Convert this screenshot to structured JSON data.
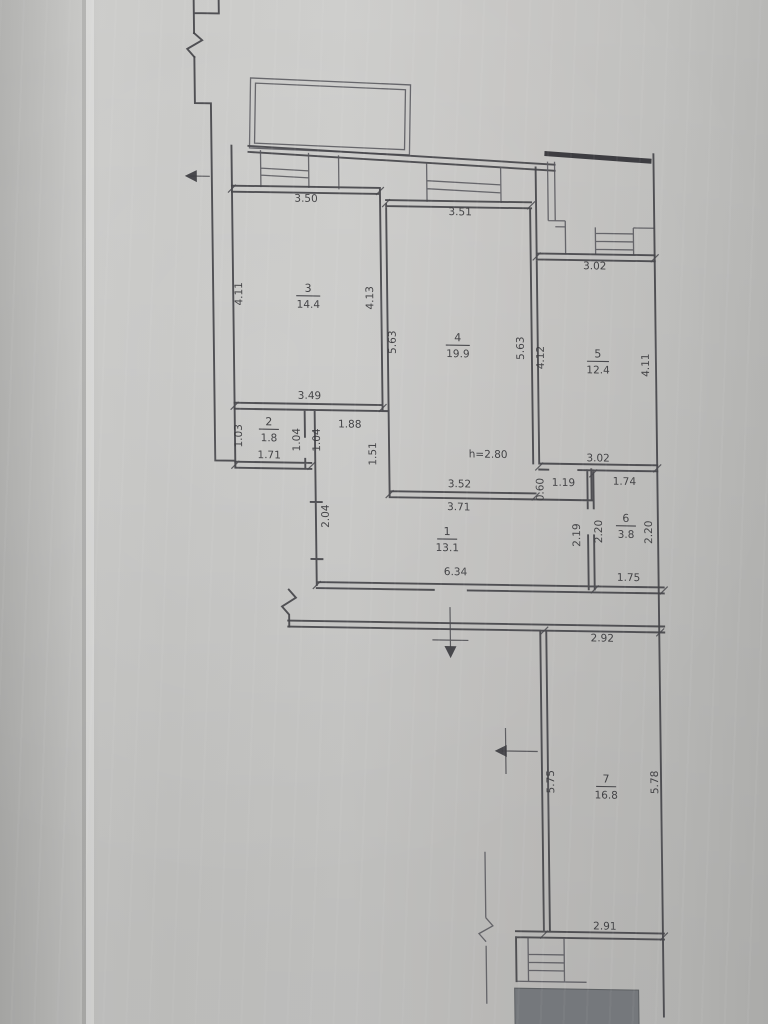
{
  "page": {
    "title": "apartment floor plan scan"
  },
  "plan": {
    "ceiling_note": "h=2.80",
    "hall_dims": {
      "top_width": "1.88",
      "left_height": "1.51"
    },
    "niche_dims": {
      "width": "1.19",
      "height": "0.60"
    },
    "rooms": [
      {
        "num": "1",
        "area": "13.1",
        "dims": {
          "left": "2.04",
          "bottom": "6.34"
        }
      },
      {
        "num": "2",
        "area": "1.8",
        "dims": {
          "left": "1.03",
          "bottom": "1.71",
          "right_upper": "1.04",
          "right_lower": "1.04"
        }
      },
      {
        "num": "3",
        "area": "14.4",
        "dims": {
          "top": "3.50",
          "left": "4.11",
          "right": "4.13",
          "bottom": "3.49"
        }
      },
      {
        "num": "4",
        "area": "19.9",
        "dims": {
          "top": "3.51",
          "left": "5.63",
          "right": "5.63",
          "bottom_inner": "3.52",
          "bottom_outer": "3.71"
        }
      },
      {
        "num": "5",
        "area": "12.4",
        "dims": {
          "top": "3.02",
          "left": "4.12",
          "right": "4.11",
          "bottom": "3.02"
        }
      },
      {
        "num": "6",
        "area": "3.8",
        "dims": {
          "top": "1.74",
          "left": "2.20",
          "right": "2.20",
          "bottom": "1.75",
          "outside_left": "2.19"
        }
      },
      {
        "num": "7",
        "area": "16.8",
        "dims": {
          "top": "2.92",
          "left": "5.75",
          "right": "5.78",
          "bottom": "2.91"
        }
      }
    ]
  }
}
